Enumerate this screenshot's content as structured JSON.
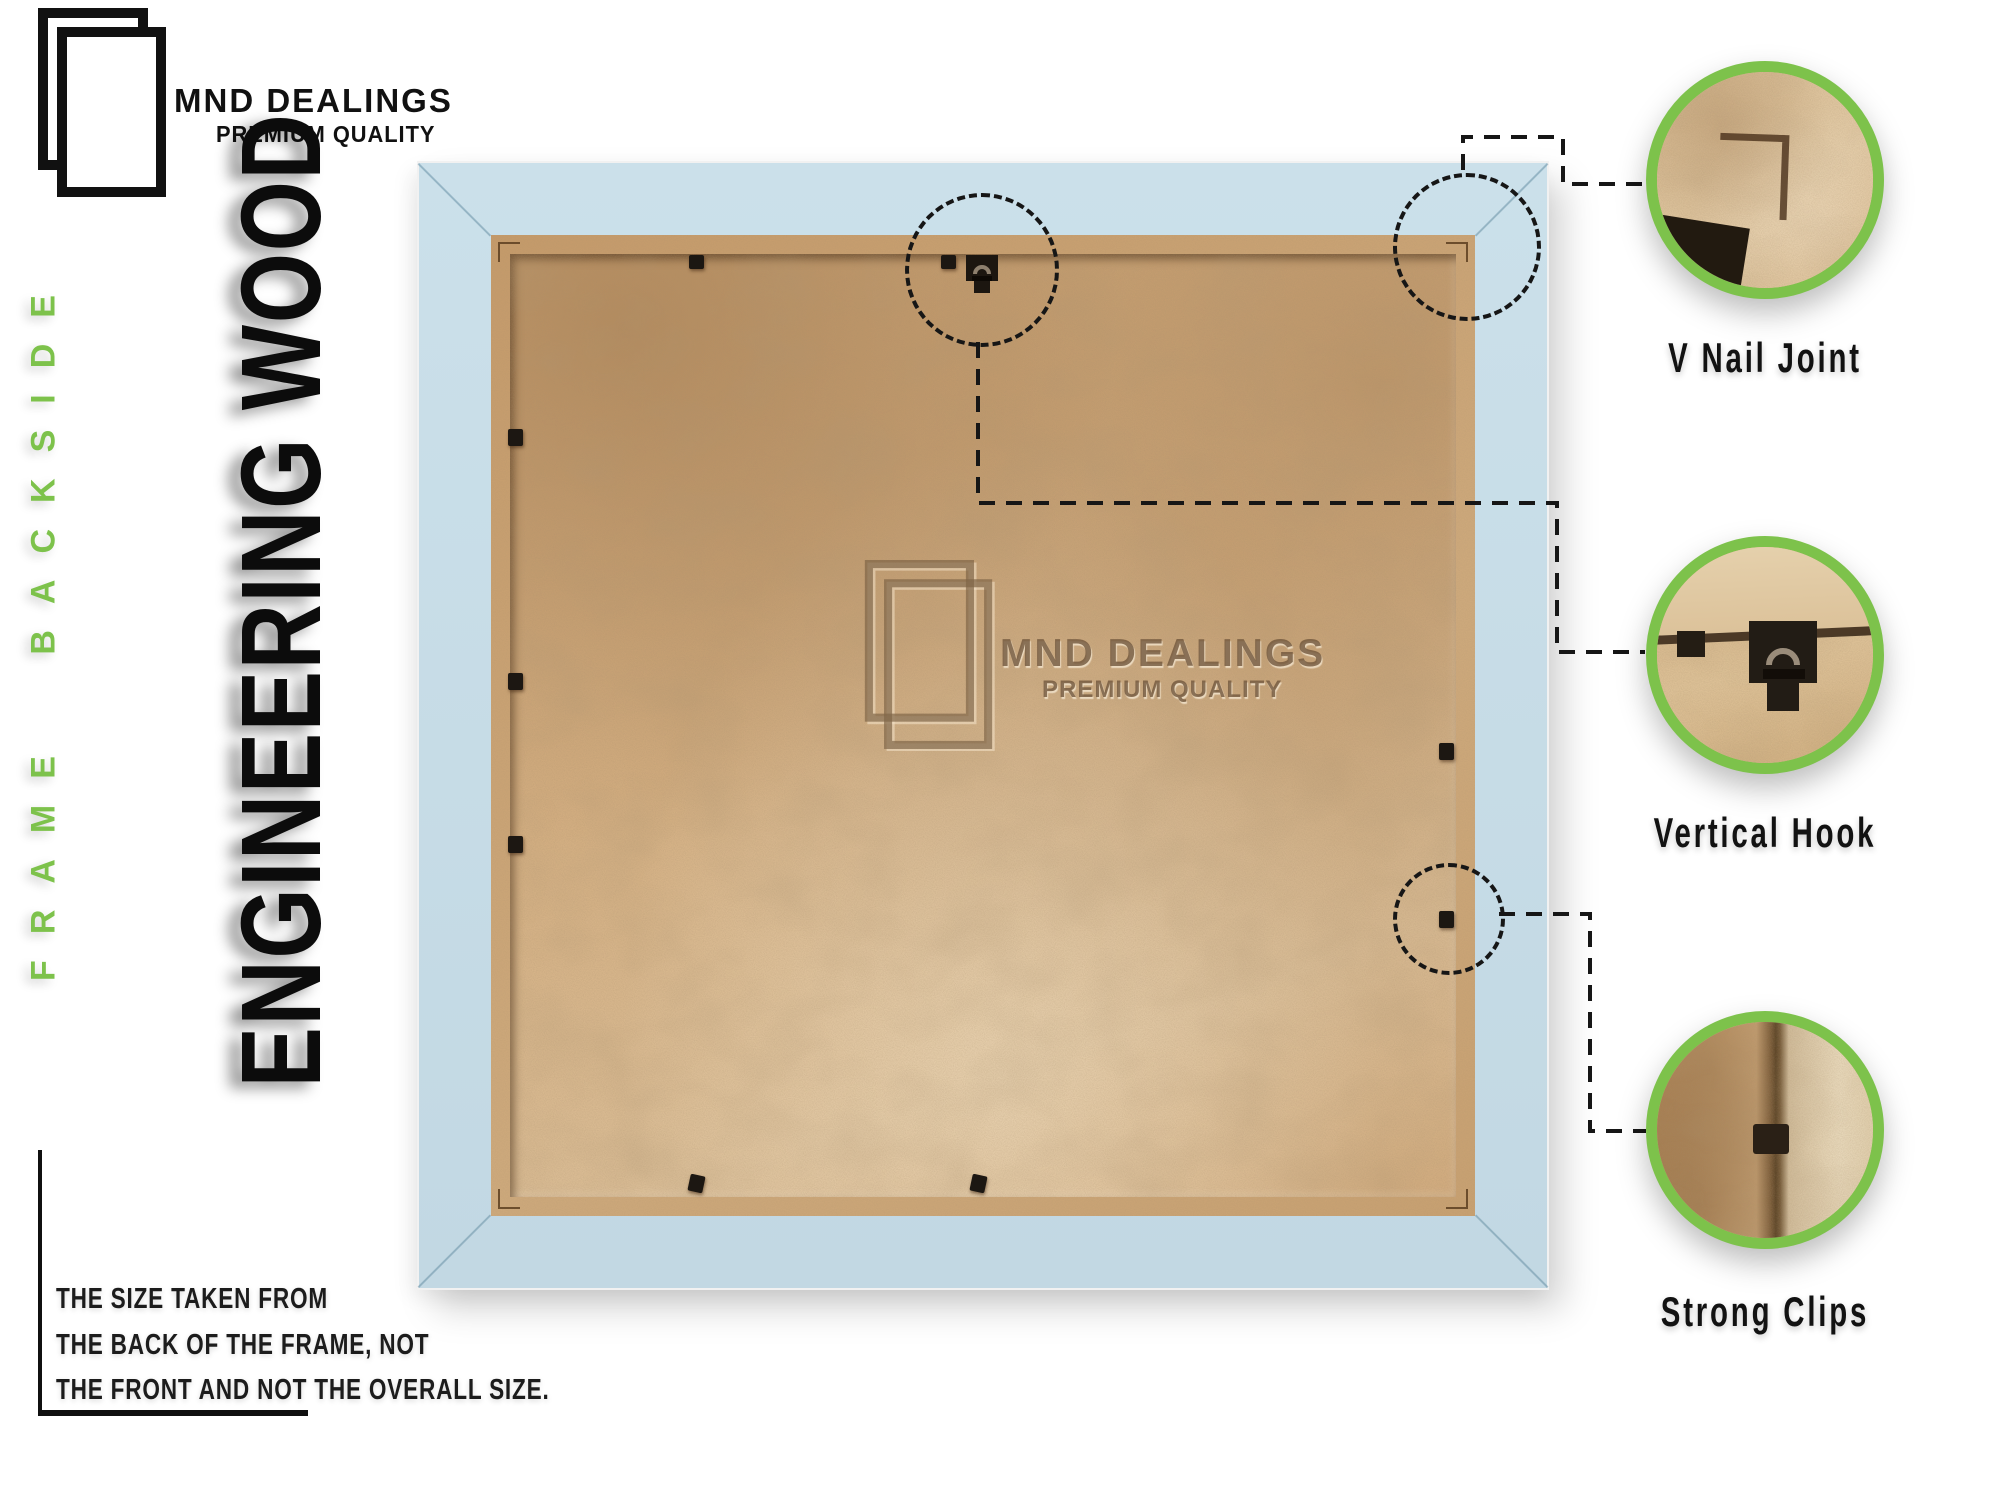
{
  "brand": {
    "name": "MND DEALINGS",
    "tagline": "PREMIUM QUALITY"
  },
  "side_labels": {
    "frame_backside": "FRAME BACKSIDE",
    "engineering_wood": "ENGINEERING WOOD"
  },
  "watermark": {
    "name": "MND DEALINGS",
    "tagline": "PREMIUM QUALITY"
  },
  "callouts": [
    {
      "label": "V Nail Joint"
    },
    {
      "label": "Vertical Hook"
    },
    {
      "label": "Strong Clips"
    }
  ],
  "note": {
    "lines": [
      "THE SIZE TAKEN FROM",
      "THE BACK OF THE FRAME, NOT",
      "THE FRONT AND NOT THE OVERALL SIZE."
    ]
  },
  "colors": {
    "accent_green": "#7dc24b",
    "frame_blue": "#c7dde8",
    "panel_tan": "#cfa87e",
    "text_black": "#161616"
  }
}
